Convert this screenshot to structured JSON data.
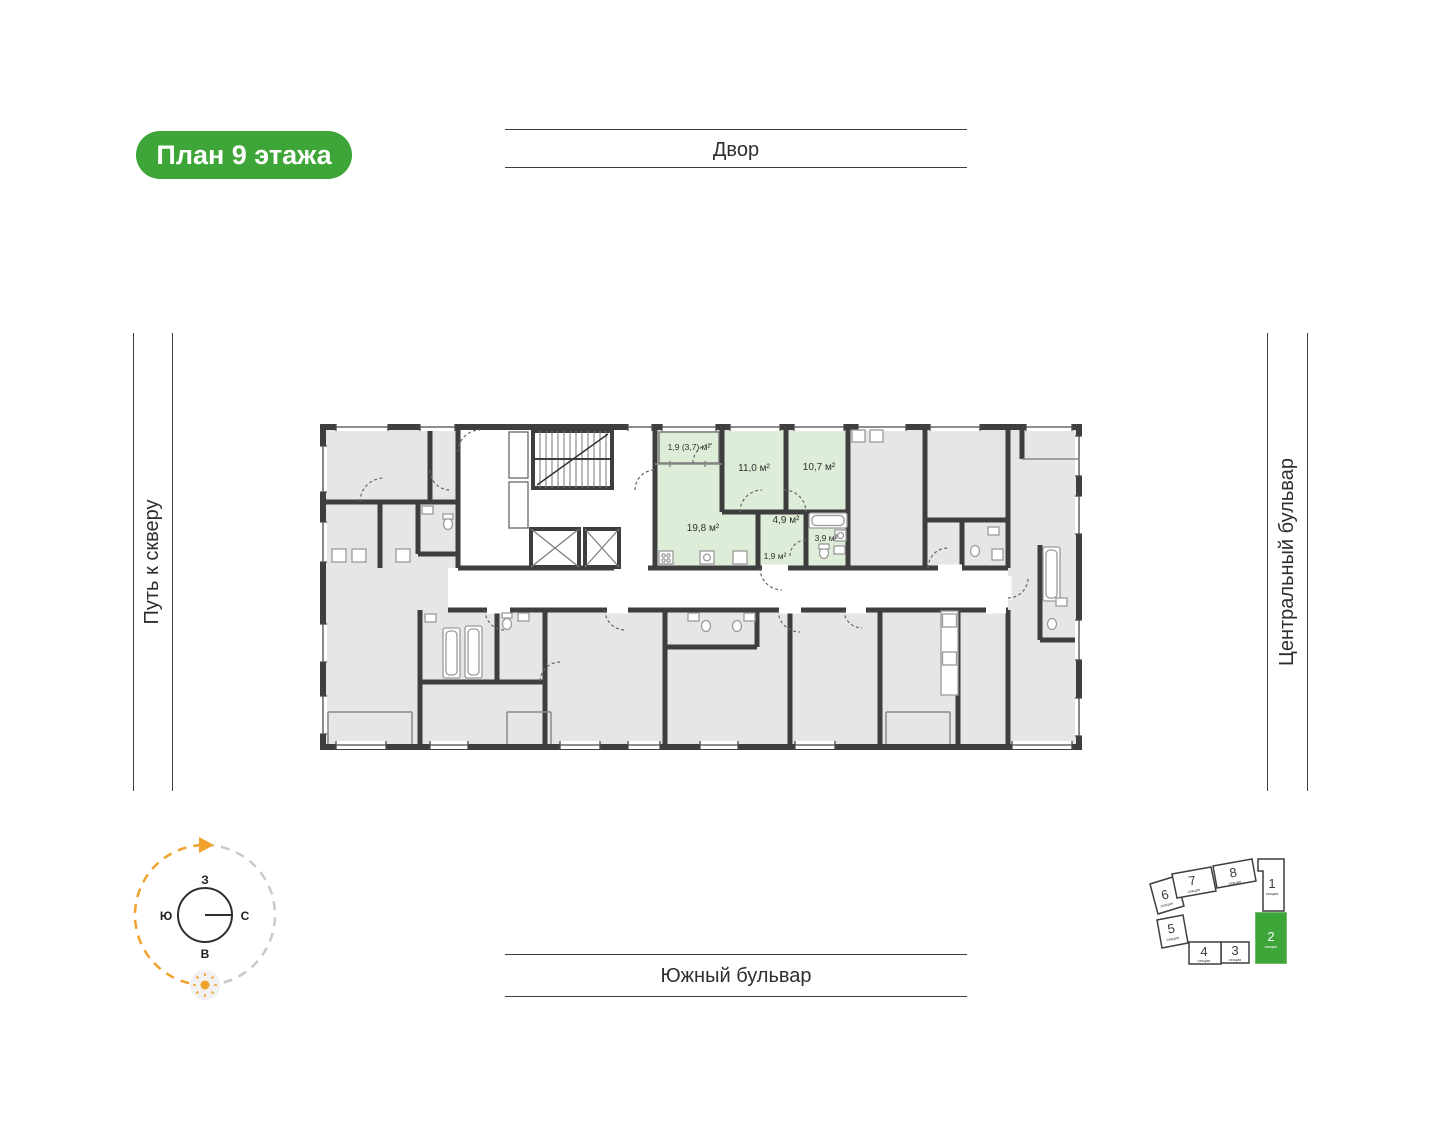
{
  "badge": {
    "label": "План 9 этажа"
  },
  "surroundings": {
    "top": "Двор",
    "left": "Путь к скверу",
    "right": "Центральный бульвар",
    "bottom": "Южный бульвар"
  },
  "compass": {
    "west": "З",
    "south": "Ю",
    "north": "С",
    "east": "В"
  },
  "selected_apartment": {
    "highlight_color": "#DEEDD8",
    "rooms": [
      {
        "name": "balcony",
        "area_label": "1,9 (3,7) м²"
      },
      {
        "name": "bedroom-1",
        "area_label": "11,0 м²"
      },
      {
        "name": "bedroom-2",
        "area_label": "10,7 м²"
      },
      {
        "name": "living-kitchen",
        "area_label": "19,8 м²"
      },
      {
        "name": "hallway",
        "area_label": "4,9 м²"
      },
      {
        "name": "bathroom",
        "area_label": "3,9 м²"
      },
      {
        "name": "corridor",
        "area_label": "1,9 м²"
      }
    ]
  },
  "minimap": {
    "active_section": "2",
    "active_color": "#3EA538",
    "sections": [
      {
        "number": "1",
        "label": "секция",
        "active": false
      },
      {
        "number": "2",
        "label": "секция",
        "active": true
      },
      {
        "number": "3",
        "label": "секция",
        "active": false
      },
      {
        "number": "4",
        "label": "секция",
        "active": false
      },
      {
        "number": "5",
        "label": "секция",
        "active": false
      },
      {
        "number": "6",
        "label": "секция",
        "active": false
      },
      {
        "number": "7",
        "label": "секция",
        "active": false
      },
      {
        "number": "8",
        "label": "секция",
        "active": false
      }
    ]
  },
  "colors": {
    "accent_green": "#3EA538",
    "apartment_highlight": "#DEEDD8",
    "wall": "#3E3E3E",
    "room_fill": "#E6E7E5",
    "sun_orange": "#F0A22C"
  }
}
